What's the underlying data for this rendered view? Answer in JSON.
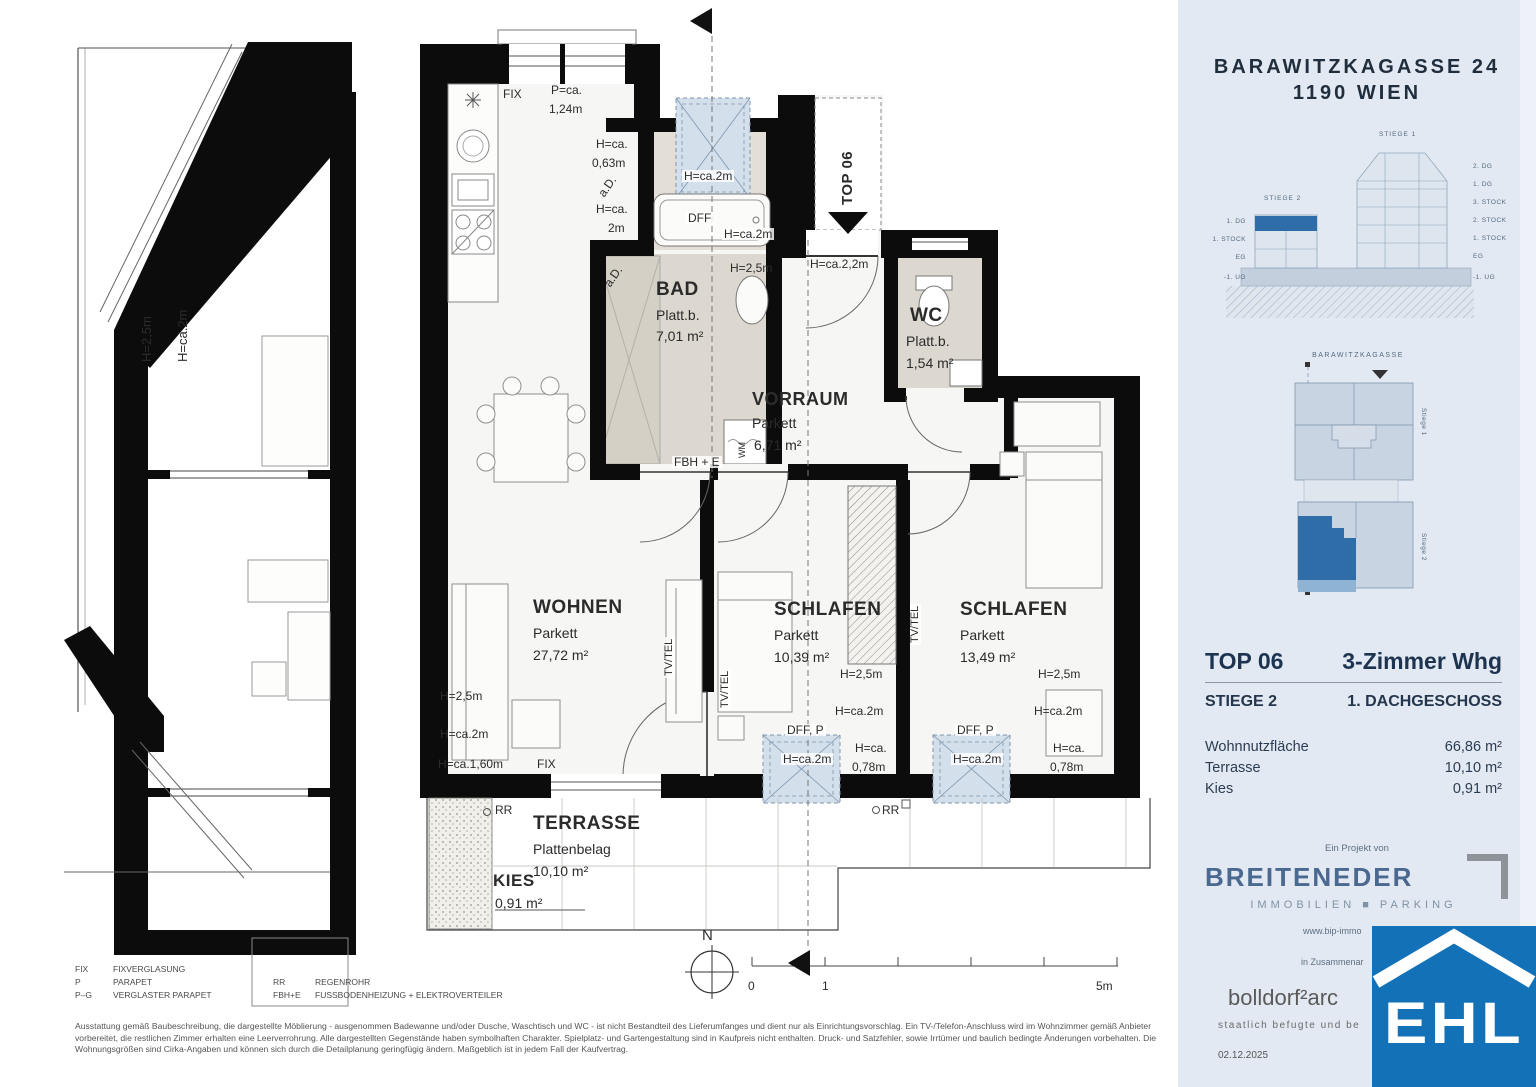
{
  "colors": {
    "sidebar_bg": "#e3e9f2",
    "accent_blue": "#2f6da8",
    "ehl_blue": "#1371b8",
    "wall_black": "#0c0c0c",
    "bath_fill": "#ddd8cf",
    "skylight_fill": "#d3dfeb",
    "brand_blue": "#4a6890"
  },
  "sidebar": {
    "address_line1": "BARAWITZKAGASSE 24",
    "address_line2": "1190 WIEN",
    "elevation": {
      "stiege1_label": "STIEGE 1",
      "stiege2_label": "STIEGE 2",
      "left_floors": [
        {
          "t": "1. DG",
          "x": 60,
          "y": 90
        },
        {
          "t": "1. STOCK",
          "x": 60,
          "y": 108
        },
        {
          "t": "EG",
          "x": 60,
          "y": 126
        },
        {
          "t": "-1. UG",
          "x": 60,
          "y": 146
        }
      ],
      "right_floors": [
        {
          "t": "2. DG",
          "x": 287,
          "y": 35
        },
        {
          "t": "1. DG",
          "x": 287,
          "y": 53
        },
        {
          "t": "3. STOCK",
          "x": 287,
          "y": 71
        },
        {
          "t": "2. STOCK",
          "x": 287,
          "y": 89
        },
        {
          "t": "1. STOCK",
          "x": 287,
          "y": 107
        },
        {
          "t": "EG",
          "x": 287,
          "y": 125
        },
        {
          "t": "-1. UG",
          "x": 287,
          "y": 146
        }
      ]
    },
    "siteplan": {
      "street_label": "BARAWITZKAGASSE",
      "stiege1_label": "Stiege 1",
      "stiege2_label": "Stiege 2"
    },
    "unit": {
      "top_label": "TOP 06",
      "type_label": "3-Zimmer Whg",
      "stiege": "STIEGE 2",
      "floor": "1. DACHGESCHOSS",
      "areas": [
        {
          "label": "Wohnnutzfläche",
          "value": "66,86 m²"
        },
        {
          "label": "Terrasse",
          "value": "10,10 m²"
        },
        {
          "label": "Kies",
          "value": "0,91 m²"
        }
      ]
    },
    "project": {
      "prefix": "Ein Projekt von",
      "brand": "BREITENEDER",
      "brand_sub": "IMMOBILIEN ■ PARKING",
      "website": "www.bip-immo",
      "cooperation": "in Zusammenar",
      "architect": "bolldorf²arc",
      "architect_sub": "staatlich befugte und be",
      "date": "02.12.2025",
      "ehl": "EHL"
    }
  },
  "legend": {
    "col1": [
      {
        "abbr": "FIX",
        "desc": "FIXVERGLASUNG"
      },
      {
        "abbr": "P",
        "desc": "PARAPET"
      },
      {
        "abbr": "P–G",
        "desc": "VERGLASTER PARAPET"
      }
    ],
    "col2": [
      {
        "abbr": "RR",
        "desc": "REGENROHR"
      },
      {
        "abbr": "FBH+E",
        "desc": "FUSSBODENHEIZUNG + ELEKTROVERTEILER"
      }
    ]
  },
  "disclaimer": "Ausstattung gemäß Baubeschreibung, die dargestellte Möblierung - ausgenommen Badewanne und/oder Dusche, Waschtisch und WC - ist nicht Bestandteil des Lieferumfanges und dient nur als Einrichtungsvorschlag. Ein TV-/Telefon-Anschluss wird im Wohnzimmer gemäß Anbieter vorbereitet, die restlichen Zimmer erhalten eine Leerverrohrung. Alle dargestellten Gegenstände haben symbolhaften Charakter. Spielplatz- und Gartengestaltung sind in Kaufpreis nicht enthalten. Druck- und Satzfehler, sowie Irrtümer und baulich bedingte Änderungen vorbehalten. Die Wohnungsgrößen sind Cirka-Angaben und können sich durch die Detailplanung geringfügig ändern. Maßgeblich ist in jedem Fall der Kaufvertrag.",
  "plan": {
    "labels": [
      {
        "t": "FIX",
        "x": 503,
        "y": 88,
        "s": 12
      },
      {
        "t": "P=ca.",
        "x": 551,
        "y": 84,
        "s": 12
      },
      {
        "t": "1,24m",
        "x": 549,
        "y": 103,
        "s": 12
      },
      {
        "t": "H=ca.",
        "x": 596,
        "y": 138,
        "s": 12
      },
      {
        "t": "0,63m",
        "x": 592,
        "y": 157,
        "s": 12
      },
      {
        "t": "a.D.",
        "x": 596,
        "y": 192,
        "s": 12,
        "r": -55
      },
      {
        "t": "H=ca.",
        "x": 596,
        "y": 203,
        "s": 12
      },
      {
        "t": "2m",
        "x": 608,
        "y": 222,
        "s": 12
      },
      {
        "t": "H=ca.2m",
        "x": 682,
        "y": 170,
        "s": 12,
        "bg": 1
      },
      {
        "t": "DFF",
        "x": 686,
        "y": 212,
        "s": 12,
        "bg": 1
      },
      {
        "t": "H=ca.2m",
        "x": 722,
        "y": 228,
        "s": 12,
        "bg": 1
      },
      {
        "t": "H=2,5m",
        "x": 730,
        "y": 262,
        "s": 12
      },
      {
        "t": "a.D.",
        "x": 602,
        "y": 282,
        "s": 12,
        "r": -55
      },
      {
        "t": "BAD",
        "x": 656,
        "y": 280,
        "s": 19,
        "w": 700
      },
      {
        "t": "Platt.b.",
        "x": 656,
        "y": 308,
        "s": 14
      },
      {
        "t": "7,01 m²",
        "x": 656,
        "y": 329,
        "s": 14
      },
      {
        "t": "H=ca.2,2m",
        "x": 810,
        "y": 258,
        "s": 12
      },
      {
        "t": "TOP 06",
        "x": 840,
        "y": 205,
        "s": 15,
        "w": 700,
        "r": -90
      },
      {
        "t": "WC",
        "x": 910,
        "y": 306,
        "s": 19,
        "w": 700
      },
      {
        "t": "Platt.b.",
        "x": 906,
        "y": 334,
        "s": 14
      },
      {
        "t": "1,54 m²",
        "x": 906,
        "y": 356,
        "s": 14
      },
      {
        "t": "VORRAUM",
        "x": 752,
        "y": 390,
        "s": 18,
        "w": 700
      },
      {
        "t": "Parkett",
        "x": 752,
        "y": 416,
        "s": 14
      },
      {
        "t": "6,71 m²",
        "x": 754,
        "y": 438,
        "s": 14
      },
      {
        "t": "FBH + E",
        "x": 672,
        "y": 456,
        "s": 12,
        "bg": 1
      },
      {
        "t": "WM",
        "x": 738,
        "y": 458,
        "s": 9,
        "r": -90
      },
      {
        "t": "WOHNEN",
        "x": 533,
        "y": 598,
        "s": 19,
        "w": 700
      },
      {
        "t": "Parkett",
        "x": 533,
        "y": 626,
        "s": 14
      },
      {
        "t": "27,72 m²",
        "x": 533,
        "y": 648,
        "s": 14
      },
      {
        "t": "TV/TEL",
        "x": 664,
        "y": 678,
        "s": 11,
        "r": -90,
        "bg": 1
      },
      {
        "t": "TV/TEL",
        "x": 720,
        "y": 710,
        "s": 11,
        "r": -90,
        "bg": 1
      },
      {
        "t": "TV/TEL",
        "x": 910,
        "y": 645,
        "s": 11,
        "r": -90,
        "bg": 1
      },
      {
        "t": "SCHLAFEN",
        "x": 774,
        "y": 600,
        "s": 19,
        "w": 700
      },
      {
        "t": "Parkett",
        "x": 774,
        "y": 628,
        "s": 14
      },
      {
        "t": "10,39 m²",
        "x": 774,
        "y": 650,
        "s": 14
      },
      {
        "t": "SCHLAFEN",
        "x": 960,
        "y": 600,
        "s": 19,
        "w": 700
      },
      {
        "t": "Parkett",
        "x": 960,
        "y": 628,
        "s": 14
      },
      {
        "t": "13,49 m²",
        "x": 960,
        "y": 650,
        "s": 14
      },
      {
        "t": "H=2,5m",
        "x": 440,
        "y": 690,
        "s": 12
      },
      {
        "t": "H=ca.2m",
        "x": 440,
        "y": 728,
        "s": 12
      },
      {
        "t": "H=ca.1,60m",
        "x": 438,
        "y": 758,
        "s": 12
      },
      {
        "t": "FIX",
        "x": 537,
        "y": 758,
        "s": 12
      },
      {
        "t": "H=2,5m",
        "x": 840,
        "y": 668,
        "s": 12
      },
      {
        "t": "H=ca.2m",
        "x": 835,
        "y": 705,
        "s": 12
      },
      {
        "t": "DFF, P",
        "x": 785,
        "y": 724,
        "s": 12,
        "bg": 1
      },
      {
        "t": "H=ca.2m",
        "x": 781,
        "y": 753,
        "s": 12,
        "bg": 1
      },
      {
        "t": "H=ca.",
        "x": 855,
        "y": 742,
        "s": 12
      },
      {
        "t": "0,78m",
        "x": 852,
        "y": 761,
        "s": 12
      },
      {
        "t": "H=2,5m",
        "x": 1038,
        "y": 668,
        "s": 12
      },
      {
        "t": "H=ca.2m",
        "x": 1034,
        "y": 705,
        "s": 12
      },
      {
        "t": "DFF, P",
        "x": 955,
        "y": 724,
        "s": 12,
        "bg": 1
      },
      {
        "t": "H=ca.2m",
        "x": 951,
        "y": 753,
        "s": 12,
        "bg": 1
      },
      {
        "t": "H=ca.",
        "x": 1053,
        "y": 742,
        "s": 12
      },
      {
        "t": "0,78m",
        "x": 1050,
        "y": 761,
        "s": 12
      },
      {
        "t": "RR",
        "x": 495,
        "y": 804,
        "s": 12
      },
      {
        "t": "RR",
        "x": 882,
        "y": 804,
        "s": 12
      },
      {
        "t": "TERRASSE",
        "x": 533,
        "y": 814,
        "s": 19,
        "w": 700
      },
      {
        "t": "Plattenbelag",
        "x": 533,
        "y": 842,
        "s": 14
      },
      {
        "t": "10,10 m²",
        "x": 533,
        "y": 864,
        "s": 14
      },
      {
        "t": "KIES",
        "x": 493,
        "y": 872,
        "s": 17,
        "w": 700
      },
      {
        "t": "0,91 m²",
        "x": 495,
        "y": 896,
        "s": 14
      },
      {
        "t": "N",
        "x": 702,
        "y": 928,
        "s": 15
      },
      {
        "t": "0",
        "x": 748,
        "y": 980,
        "s": 12
      },
      {
        "t": "1",
        "x": 822,
        "y": 980,
        "s": 12
      },
      {
        "t": "5m",
        "x": 1096,
        "y": 980,
        "s": 12
      },
      {
        "t": "H=2,5m",
        "x": 140,
        "y": 362,
        "s": 13,
        "r": -90
      },
      {
        "t": "H=ca.2m",
        "x": 176,
        "y": 362,
        "s": 13,
        "r": -90
      }
    ]
  }
}
